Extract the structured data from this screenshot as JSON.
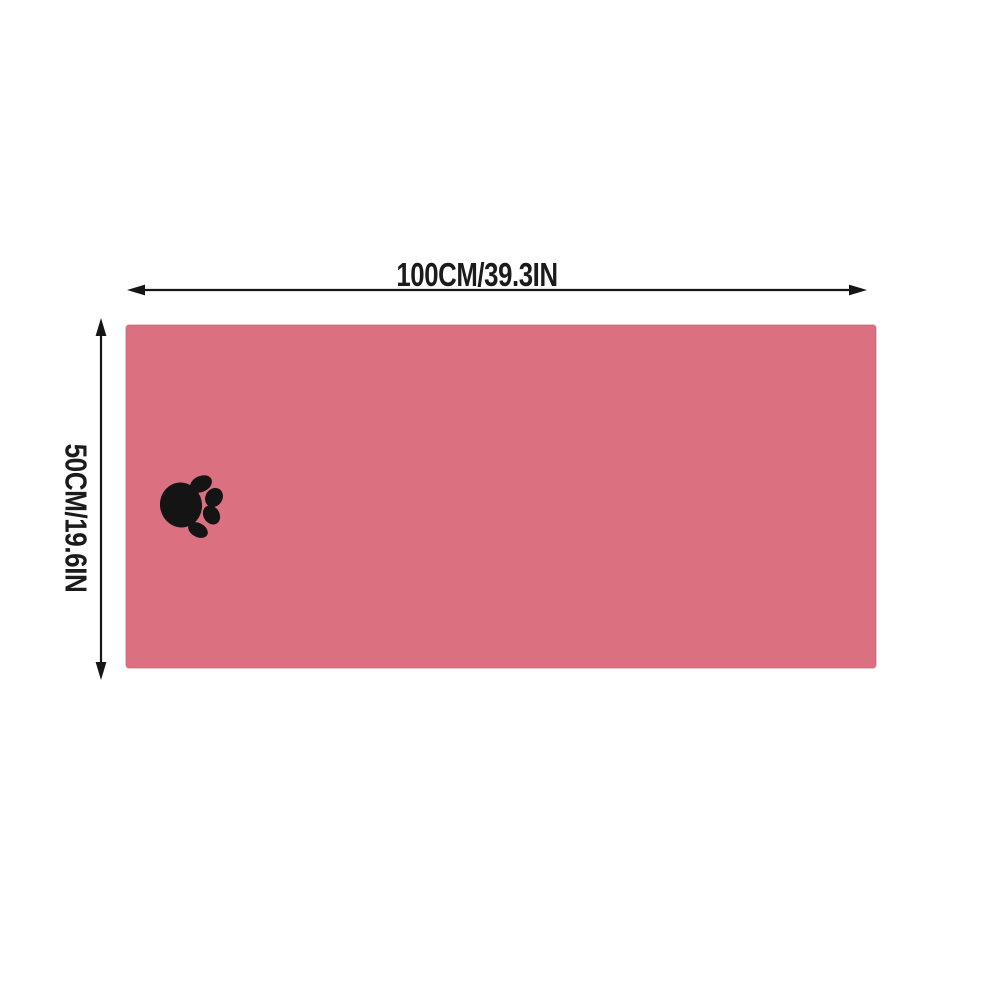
{
  "diagram": {
    "title": "pet towel size diagram",
    "width_label": "100CM/39.3IN",
    "height_label": "50CM/19.6IN",
    "towel_color": "#db7180",
    "towel_edge_color": "#c05f6e",
    "paw_color": "#141414",
    "dimension_line_color": "#161616",
    "background_color": "#ffffff",
    "icons": {
      "paw": "paw-print-icon"
    }
  }
}
